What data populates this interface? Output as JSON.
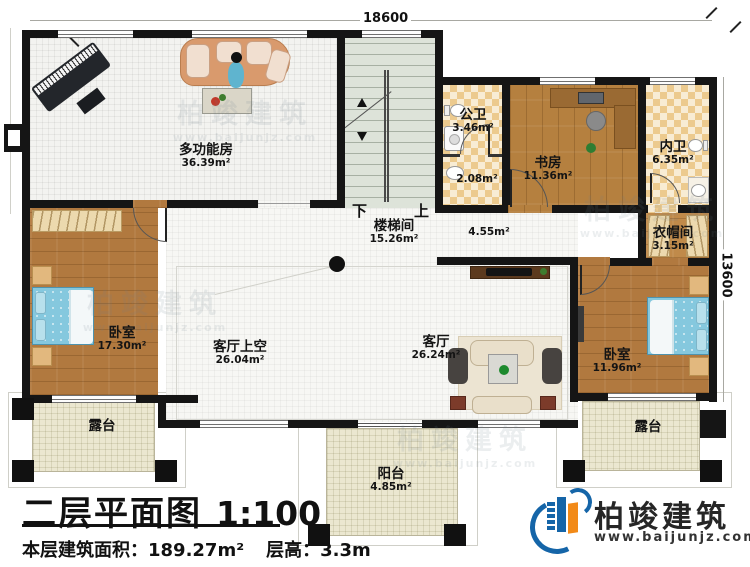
{
  "title_block": {
    "title": "二层平面图",
    "scale": "1:100",
    "area": "本层建筑面积：189.27m²",
    "floor_height": "层高：3.3m"
  },
  "brand": {
    "name": "柏竣建筑",
    "website": "www.baijunjz.com"
  },
  "watermark": {
    "name": "柏竣建筑",
    "website": "www.baijunjz.com"
  },
  "dimensions": {
    "top": "18600",
    "right": "13600"
  },
  "stair_labels": {
    "down": "下",
    "up": "上"
  },
  "rooms": [
    {
      "id": "multi-function-room",
      "name": "多功能房",
      "area": "36.39m²"
    },
    {
      "id": "stairwell",
      "name": "楼梯间",
      "area": "15.26m²"
    },
    {
      "id": "public-bath",
      "name": "公卫",
      "area": "3.46m²"
    },
    {
      "id": "washroom",
      "name": "",
      "area": "2.08m²"
    },
    {
      "id": "study",
      "name": "书房",
      "area": "11.36m²"
    },
    {
      "id": "ensuite-bath",
      "name": "内卫",
      "area": "6.35m²"
    },
    {
      "id": "cloakroom",
      "name": "衣帽间",
      "area": "3.15m²"
    },
    {
      "id": "hallway",
      "name": "",
      "area": "4.55m²"
    },
    {
      "id": "bedroom-left",
      "name": "卧室",
      "area": "17.30m²"
    },
    {
      "id": "living-void",
      "name": "客厅上空",
      "area": "26.04m²"
    },
    {
      "id": "living-room",
      "name": "客厅",
      "area": "26.24m²"
    },
    {
      "id": "bedroom-right",
      "name": "卧室",
      "area": "11.96m²"
    },
    {
      "id": "terrace-left",
      "name": "露台",
      "area": ""
    },
    {
      "id": "terrace-right",
      "name": "露台",
      "area": ""
    },
    {
      "id": "balcony",
      "name": "阳台",
      "area": "4.85m²"
    }
  ]
}
